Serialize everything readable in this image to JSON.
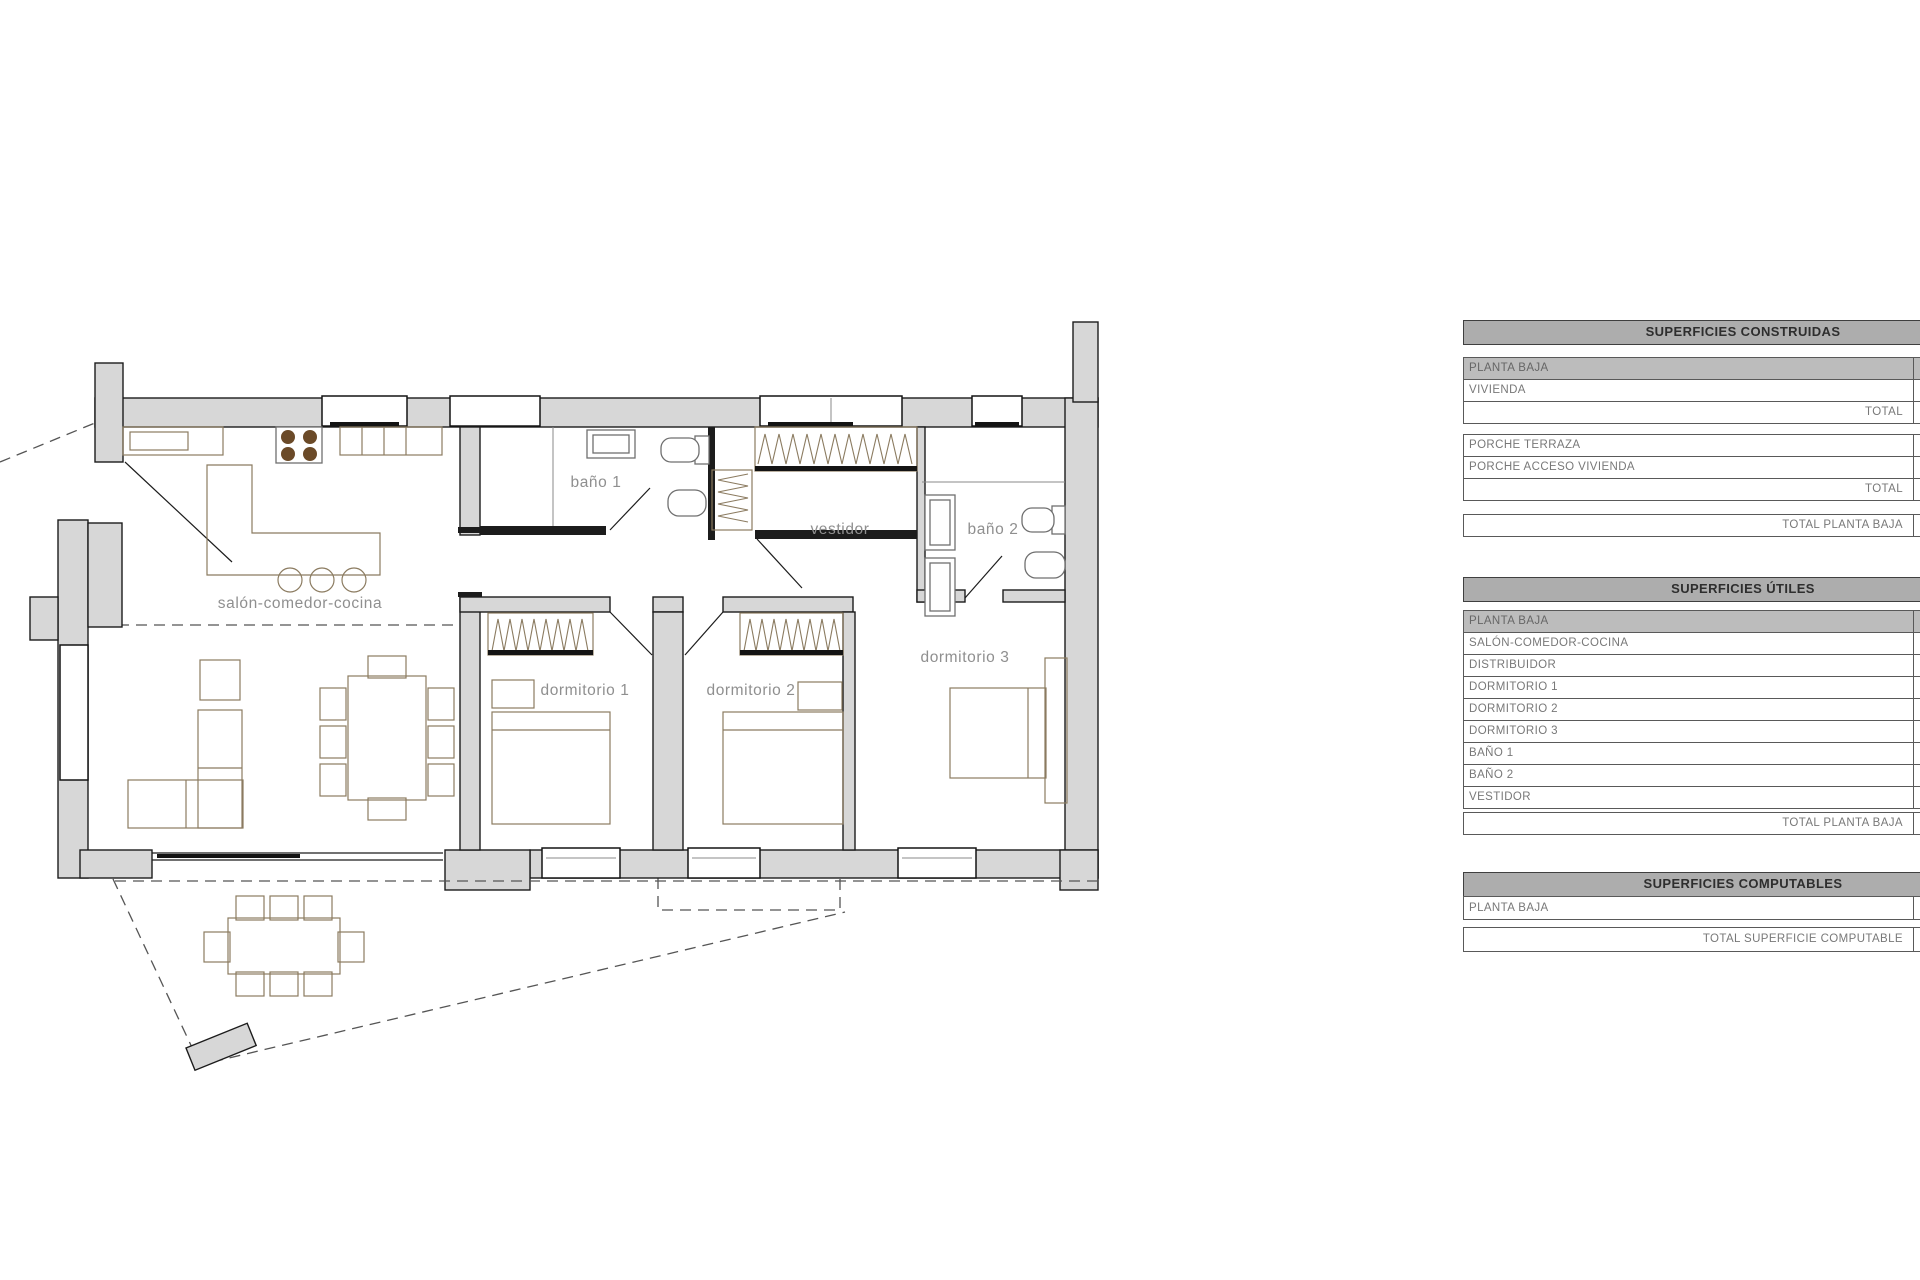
{
  "plan": {
    "room_labels": {
      "salon": "salón-comedor-cocina",
      "bano1": "baño 1",
      "vestidor": "vestidor",
      "bano2": "baño 2",
      "dorm1": "dormitorio 1",
      "dorm2": "dormitorio 2",
      "dorm3": "dormitorio 3"
    }
  },
  "tables": {
    "construidas": {
      "title": "SUPERFICIES CONSTRUIDAS",
      "rows": [
        {
          "label": "PLANTA BAJA"
        },
        {
          "label": "VIVIENDA"
        },
        {
          "label": "TOTAL"
        },
        {
          "label": "PORCHE TERRAZA"
        },
        {
          "label": "PORCHE ACCESO VIVIENDA"
        },
        {
          "label": "TOTAL"
        },
        {
          "label": "TOTAL PLANTA BAJA"
        }
      ]
    },
    "utiles": {
      "title": "SUPERFICIES ÚTILES",
      "rows": [
        {
          "label": "PLANTA BAJA"
        },
        {
          "label": "SALÓN-COMEDOR-COCINA"
        },
        {
          "label": "DISTRIBUIDOR"
        },
        {
          "label": "DORMITORIO 1"
        },
        {
          "label": "DORMITORIO 2"
        },
        {
          "label": "DORMITORIO 3"
        },
        {
          "label": "BAÑO 1"
        },
        {
          "label": "BAÑO 2"
        },
        {
          "label": "VESTIDOR"
        },
        {
          "label": "TOTAL PLANTA BAJA"
        }
      ]
    },
    "computables": {
      "title": "SUPERFICIES COMPUTABLES",
      "rows": [
        {
          "label": "PLANTA BAJA"
        },
        {
          "label": "TOTAL SUPERFICIE COMPUTABLE"
        }
      ]
    }
  },
  "colors": {
    "wall_fill": "#d7d7d7",
    "table_header_bg": "#adadad",
    "table_subheader_bg": "#bcbcbc",
    "table_border": "#595959",
    "row_text": "#787878",
    "furniture_stroke": "#8b7b60",
    "room_label_text": "#8f8f8f",
    "stove_burner": "#6b4a28"
  }
}
